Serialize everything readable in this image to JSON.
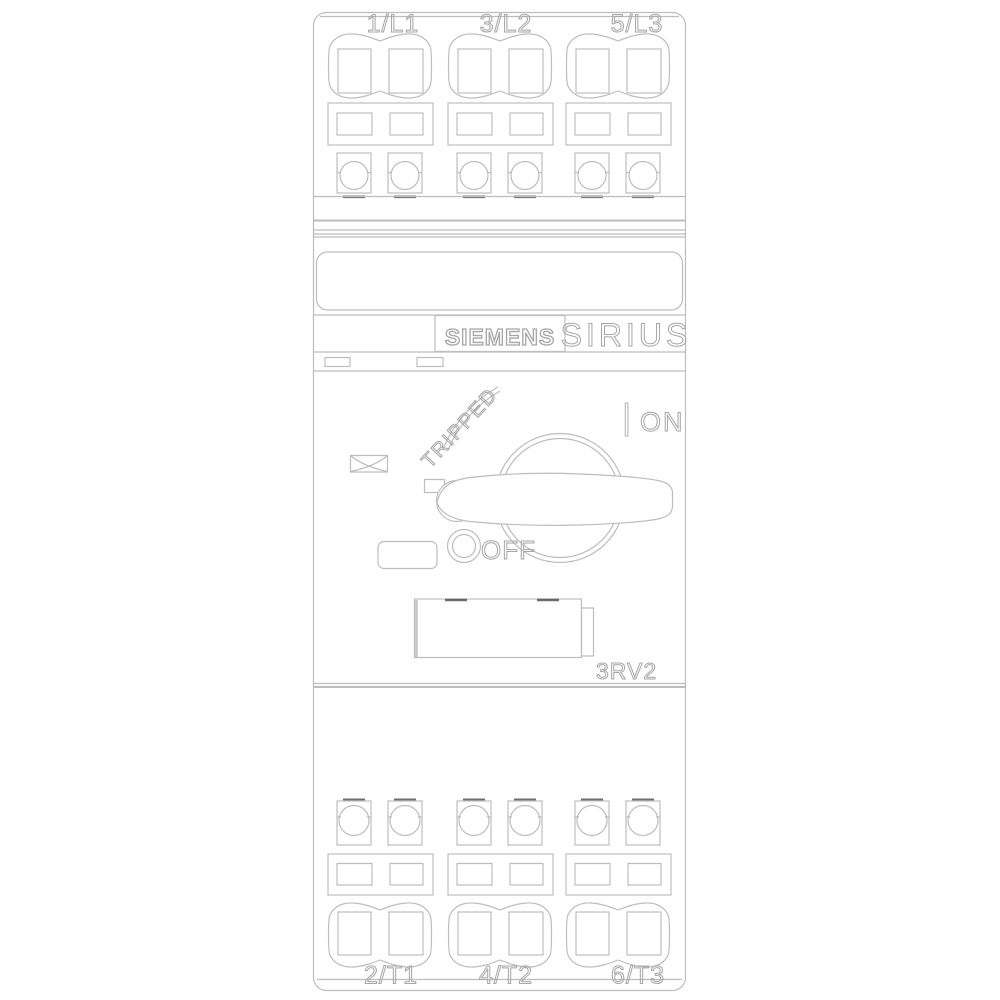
{
  "product": {
    "brand": "SIEMENS",
    "family": "SIRIUS",
    "model": "3RV2"
  },
  "terminals": {
    "top": [
      "1/L1",
      "3/L2",
      "5/L3"
    ],
    "bottom": [
      "2/T1",
      "4/T2",
      "6/T3"
    ]
  },
  "switch": {
    "tripped": "TRIPPED",
    "on": "ON",
    "off": "OFF"
  },
  "colors": {
    "line": "#bdbdbd",
    "text": "#a6a6a6",
    "dark": "#4a4a4a",
    "background": "#ffffff"
  }
}
